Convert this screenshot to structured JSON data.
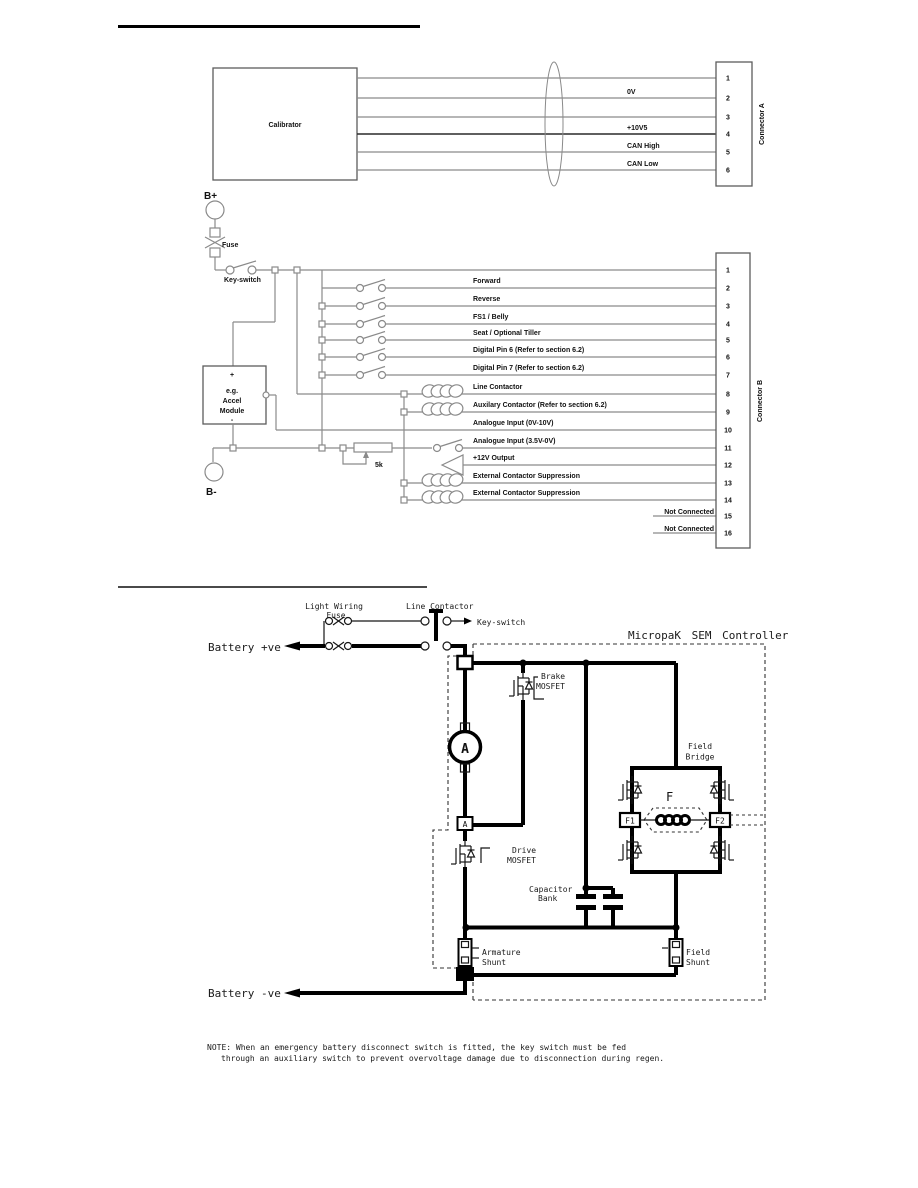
{
  "top": {
    "calibrator": "Calibrator",
    "connector": "Connector A",
    "pins": [
      "1",
      "2",
      "3",
      "4",
      "5",
      "6"
    ],
    "labels": {
      "ov": "0V",
      "v105": "+10V5",
      "canh": "CAN High",
      "canl": "CAN Low"
    }
  },
  "middle": {
    "bplus": "B+",
    "bminus": "B-",
    "fuse": "Fuse",
    "keyswitch": "Key-switch",
    "pot": "5k",
    "module": {
      "plus": "+",
      "eg": "e.g.",
      "accel": "Accel",
      "mod": "Module",
      "minus": "-"
    },
    "connector": "Connector B",
    "pins": [
      "1",
      "2",
      "3",
      "4",
      "5",
      "6",
      "7",
      "8",
      "9",
      "10",
      "11",
      "12",
      "13",
      "14",
      "15",
      "16"
    ],
    "labels": {
      "forward": "Forward",
      "reverse": "Reverse",
      "fs1": "FS1 / Belly",
      "seat": "Seat / Optional Tiller",
      "d6": "Digital Pin 6 (Refer to section 6.2)",
      "d7": "Digital Pin 7 (Refer to section 6.2)",
      "line_contactor": "Line Contactor",
      "aux_contactor": "Auxilary Contactor (Refer to section 6.2)",
      "analogue1": "Analogue Input (0V-10V)",
      "analogue2": "Analogue Input (3.5V-0V)",
      "out12v": "+12V Output",
      "ext1": "External Contactor Suppression",
      "ext2": "External Contactor Suppression",
      "nc1": "Not Connected",
      "nc2": "Not Connected"
    }
  },
  "bottom": {
    "light_wiring": "Light Wiring",
    "fuse": "Fuse",
    "line_contactor": "Line Contactor",
    "keyswitch": "Key-switch",
    "battery_pos": "Battery +ve",
    "battery_neg": "Battery -ve",
    "controller": "MicropaK SEM Controller",
    "brake_l1": "Brake",
    "brake_l2": "MOSFET",
    "drive_l1": "Drive",
    "drive_l2": "MOSFET",
    "bridge_l1": "Field",
    "bridge_l2": "Bridge",
    "f": "F",
    "f1": "F1",
    "f2": "F2",
    "cap_l1": "Capacitor",
    "cap_l2": "Bank",
    "ashunt_l1": "Armature",
    "ashunt_l2": "Shunt",
    "fshunt_l1": "Field",
    "fshunt_l2": "Shunt",
    "motor": "A",
    "note1": "NOTE:  When an emergency battery disconnect switch is fitted, the key switch must be fed",
    "note2": "through an auxiliary switch to prevent overvoltage damage due to disconnection during regen."
  },
  "colors": {
    "wire_gray": "#8a8a8a",
    "ink": "#000000",
    "paper": "#ffffff"
  }
}
